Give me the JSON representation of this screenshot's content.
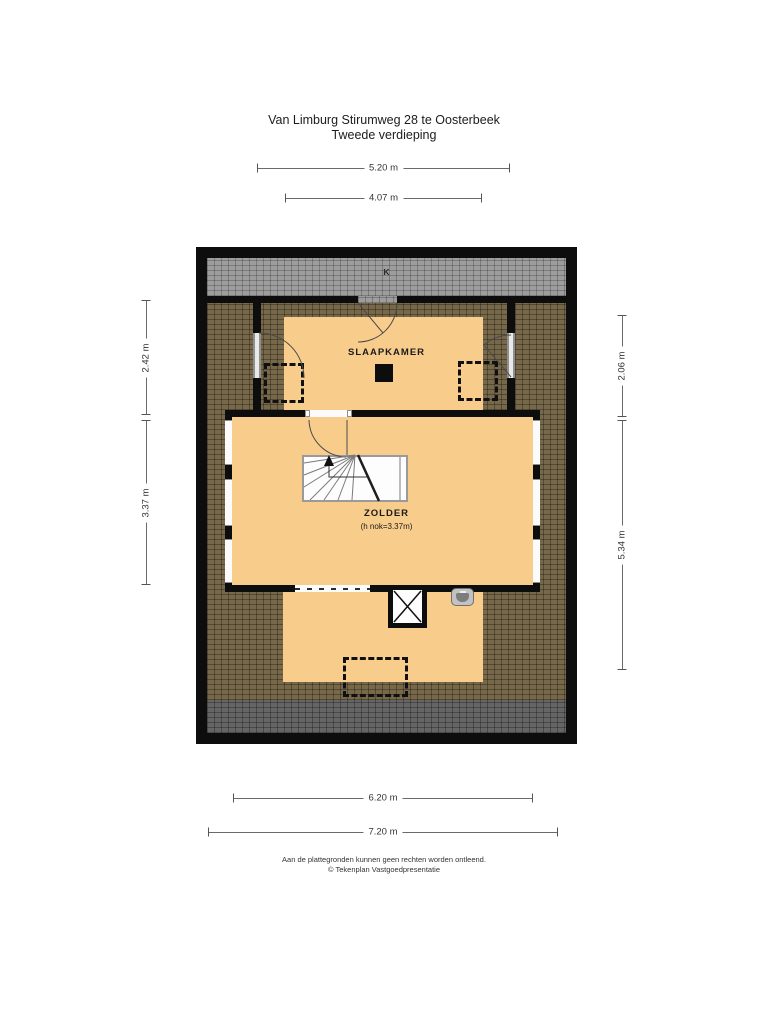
{
  "header": {
    "title_line1": "Van Limburg Stirumweg 28 te Oosterbeek",
    "title_line2": "Tweede verdieping"
  },
  "plan": {
    "roof_window_label": "K",
    "rooms": {
      "slaapkamer": {
        "label": "SLAAPKAMER"
      },
      "zolder": {
        "label": "ZOLDER",
        "height_note": "(h nok=3.37m)"
      }
    }
  },
  "dimensions": {
    "top": [
      {
        "label": "5.20 m"
      },
      {
        "label": "4.07 m"
      }
    ],
    "left": [
      {
        "label": "2.42 m"
      },
      {
        "label": "3.37 m"
      }
    ],
    "right": [
      {
        "label": "2.06 m"
      },
      {
        "label": "5.34 m"
      }
    ],
    "bottom": [
      {
        "label": "6.20 m"
      },
      {
        "label": "7.20 m"
      }
    ]
  },
  "footer": {
    "disclaimer": "Aan de plattegronden kunnen geen rechten worden ontleend.",
    "credit": "© Tekenplan Vastgoedpresentatie"
  },
  "colors": {
    "floor": "#f8cd8c",
    "roof_slope_hatch": "#77684a",
    "roof_flat_top": "#9d9d9d",
    "roof_flat_bottom": "#656565",
    "wall": "#0d0d0d"
  }
}
